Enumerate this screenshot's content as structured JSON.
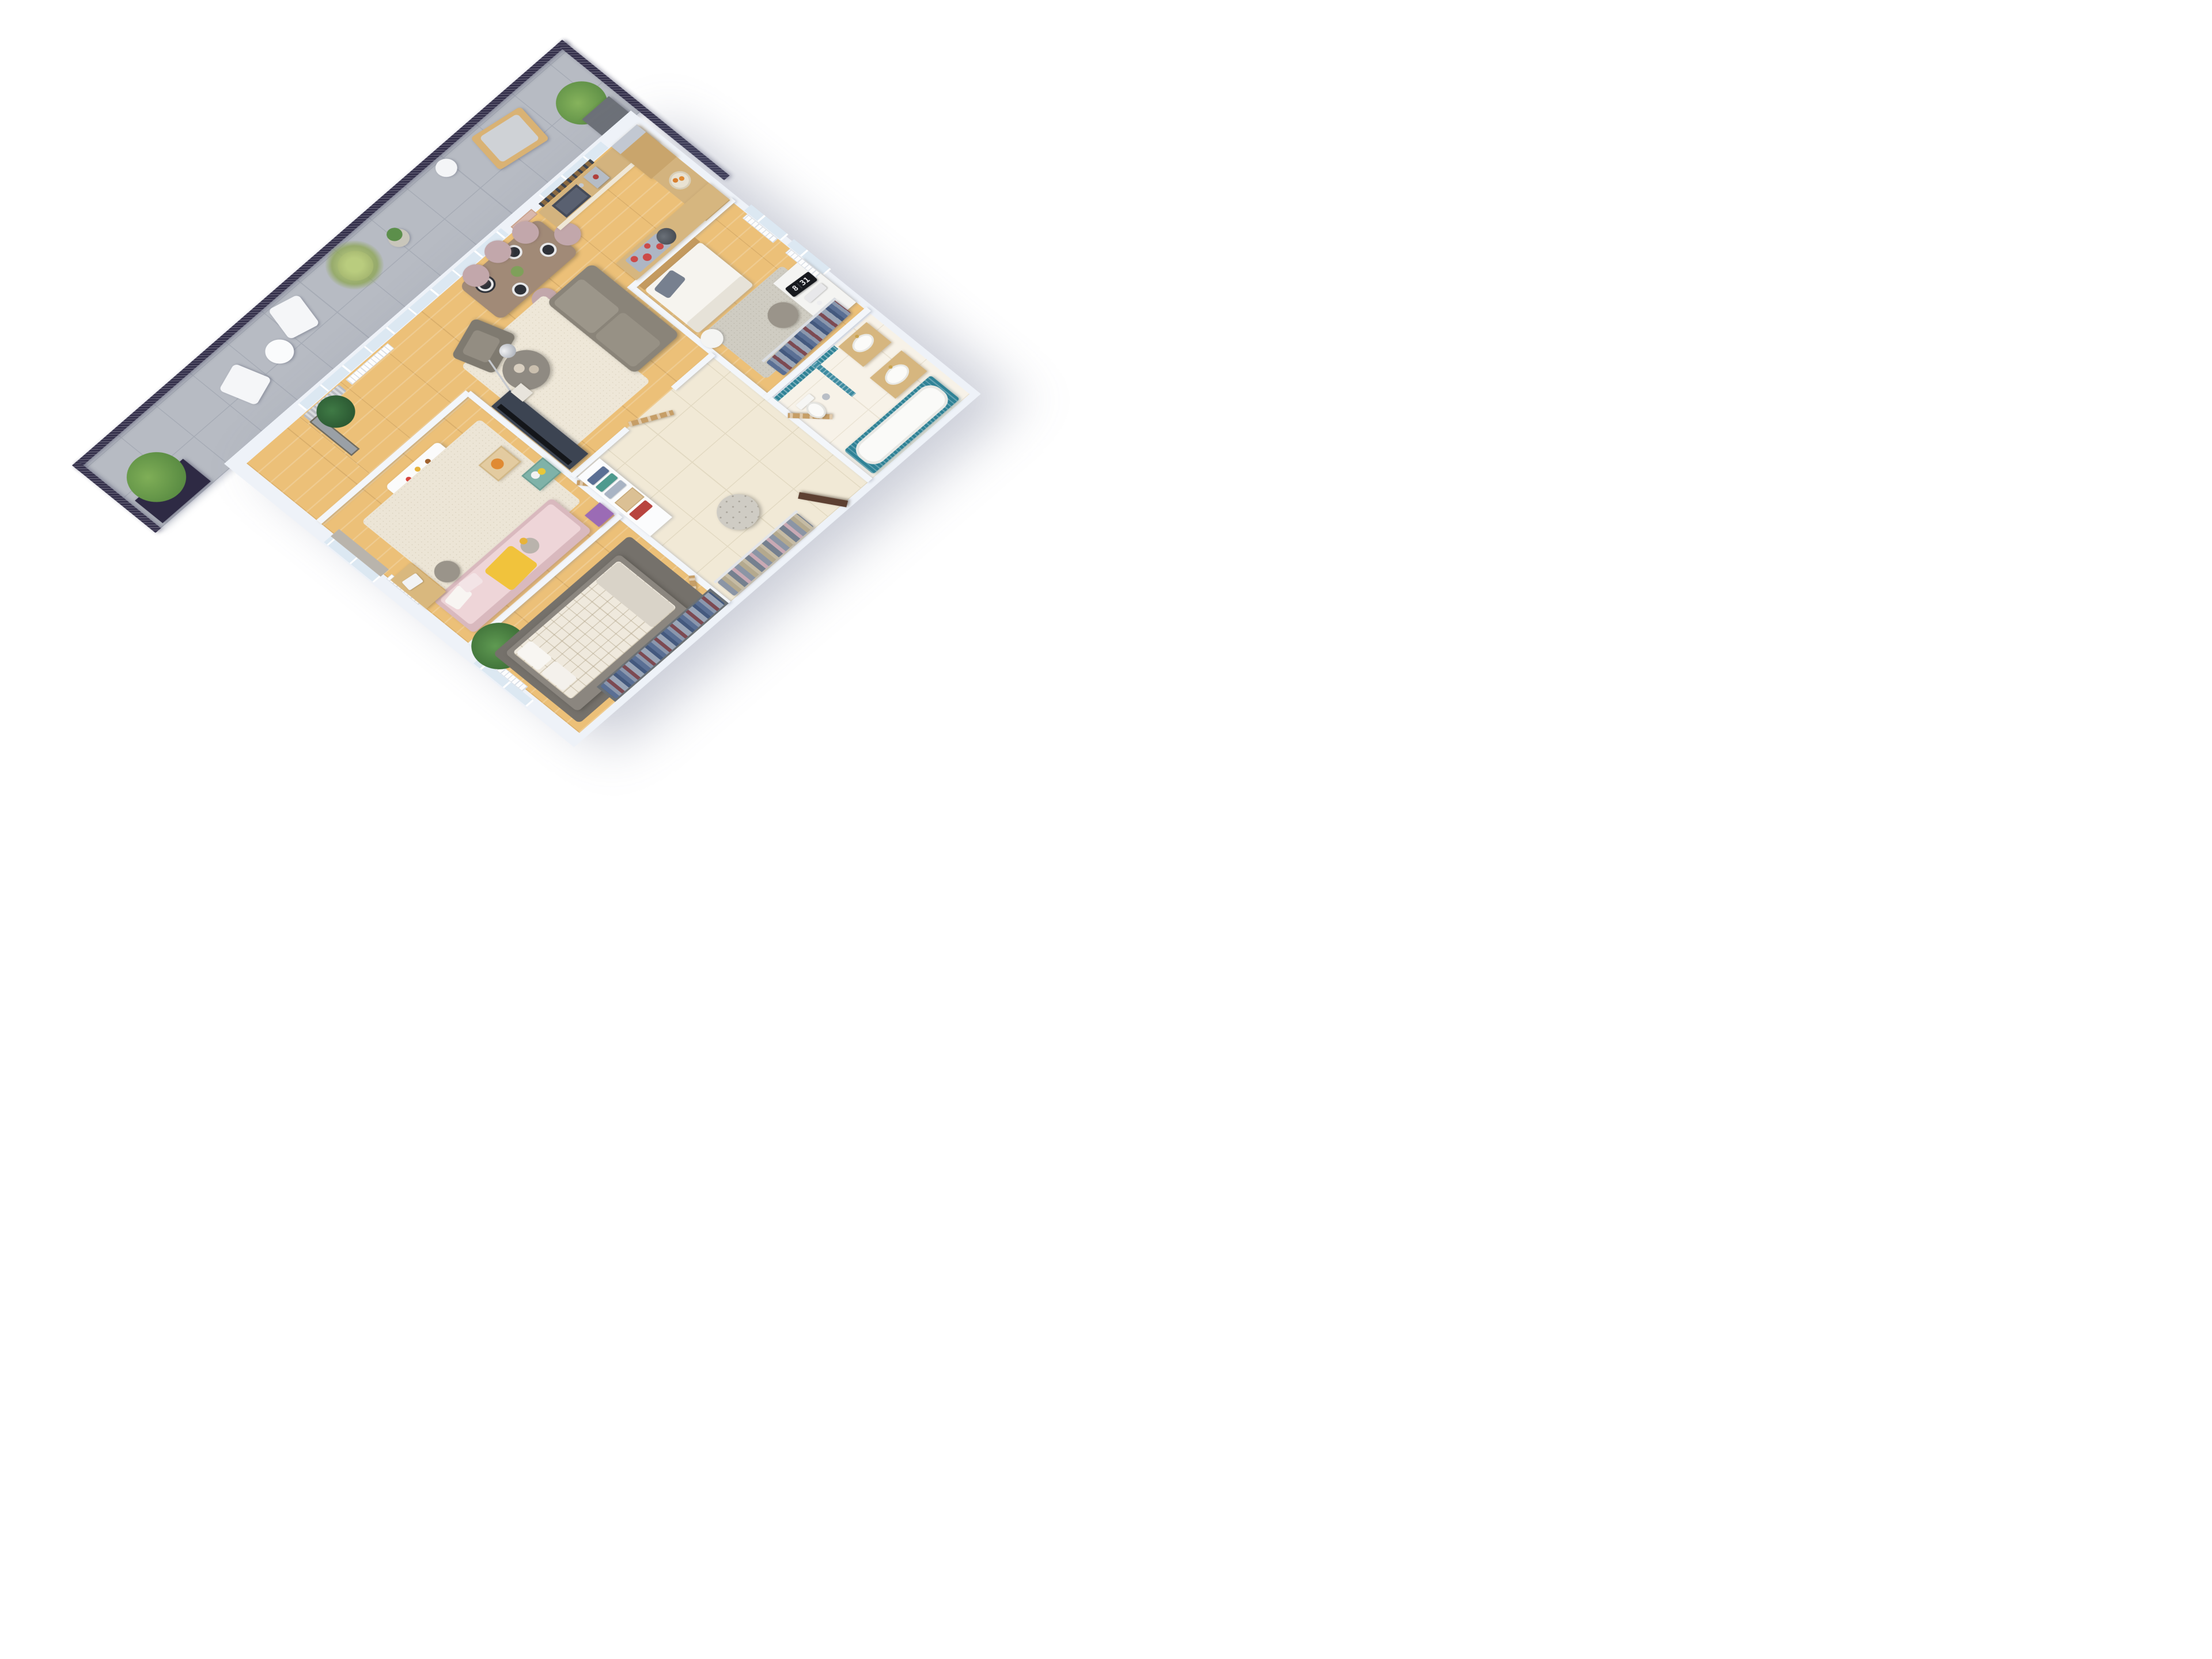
{
  "meta": {
    "title": "3D isometric apartment floor plan render",
    "background": "#ffffff",
    "view": "aerial cutaway, walls white, no text labels except desk flip clock"
  },
  "clock": {
    "hour": "8",
    "minute": "31"
  },
  "palette": {
    "wall_top": "#f3f6fa",
    "wood_floor": "#ecc078",
    "balcony_tile": "#b7bbc3",
    "railing_navy": "#332f4a",
    "hall_tile": "#f1e9d6",
    "marble": "#f7f2e8",
    "teal_mosaic": "#2f8296",
    "sofa_taupe": "#8a8479",
    "cream_rug": "#eee7d8",
    "hob_red": "#cc4a48",
    "kids_pink": "#e9cdd1",
    "kids_yellow": "#f1c33c",
    "door_wood": "#c69e67",
    "entrance_door": "#5d4032",
    "clock_face": "#17191e"
  },
  "balcony": {
    "name": "terrace",
    "items": [
      "navy planter with bush (west)",
      "white folding chair x2",
      "round side table",
      "tall grass planter",
      "aloe on wire stand",
      "white tripod floor lamp",
      "wooden deck chair with grey cushion",
      "bush planter (east)",
      "navy corner planter with bamboo",
      "mesh railing on three sides"
    ]
  },
  "rooms": [
    {
      "id": "living-dining",
      "floor": "wood",
      "items": [
        "grey curtain",
        "radiator",
        "black-and-white leaf artwork",
        "monstera plant on stand",
        "dining table with 4 place settings",
        "5 mauve dining chairs",
        "taupe sofa",
        "grey armchair",
        "arc floor lamp",
        "round coffee table with 2 bowls",
        "cream rug",
        "dark TV console",
        "flat TV"
      ]
    },
    {
      "id": "kitchen",
      "floor": "wood",
      "items": [
        "counter with dark sink",
        "faucet",
        "coffee machine",
        "wall shelves with jars",
        "wood-front fridge",
        "side counter",
        "fruit bowl with oranges",
        "island with induction hob",
        "4 red burners",
        "steel pan"
      ]
    },
    {
      "id": "bedroom",
      "floor": "wood",
      "items": [
        "double bed with wood headboard",
        "grey pillow",
        "white duvet",
        "grey rug",
        "white floor lamp",
        "white desk",
        "flip clock 8:31",
        "keyboard",
        "mouse",
        "notebook",
        "desk chair",
        "radiator x2",
        "east windows x2",
        "clothes rack with shirts",
        "pink artwork"
      ]
    },
    {
      "id": "kids-room",
      "floor": "wood",
      "items": [
        "west window with blind",
        "radiator",
        "white play table",
        "colorful building blocks",
        "green stool x2",
        "cream rug",
        "pink daybed",
        "white and pink pillows",
        "yellow blanket",
        "teddy bear",
        "toy box with orange dino",
        "teal toy box",
        "purple box",
        "kids desk with laptop",
        "grey chair"
      ]
    },
    {
      "id": "master-bedroom",
      "floor": "wood",
      "items": [
        "west window",
        "radiator",
        "palm plant",
        "dark grey rug",
        "grey bed platform",
        "white checked duvet",
        "pillows x2",
        "folded blanket",
        "built-in wardrobe with hanging shirts"
      ]
    },
    {
      "id": "hallway",
      "floor": "tile",
      "items": [
        "white shelf unit with folded clothes",
        "wooden toy crate",
        "red toolbox",
        "coat rack with jackets",
        "round tufted pouf",
        "entrance door (dark, ajar)",
        "interior wooden doors x4"
      ]
    },
    {
      "id": "bathroom",
      "floor": "marble",
      "items": [
        "teal mosaic walls",
        "bathtub with teal surround",
        "toilet",
        "steel bin",
        "wood vanity with oval sink x2",
        "gold faucets"
      ]
    }
  ]
}
